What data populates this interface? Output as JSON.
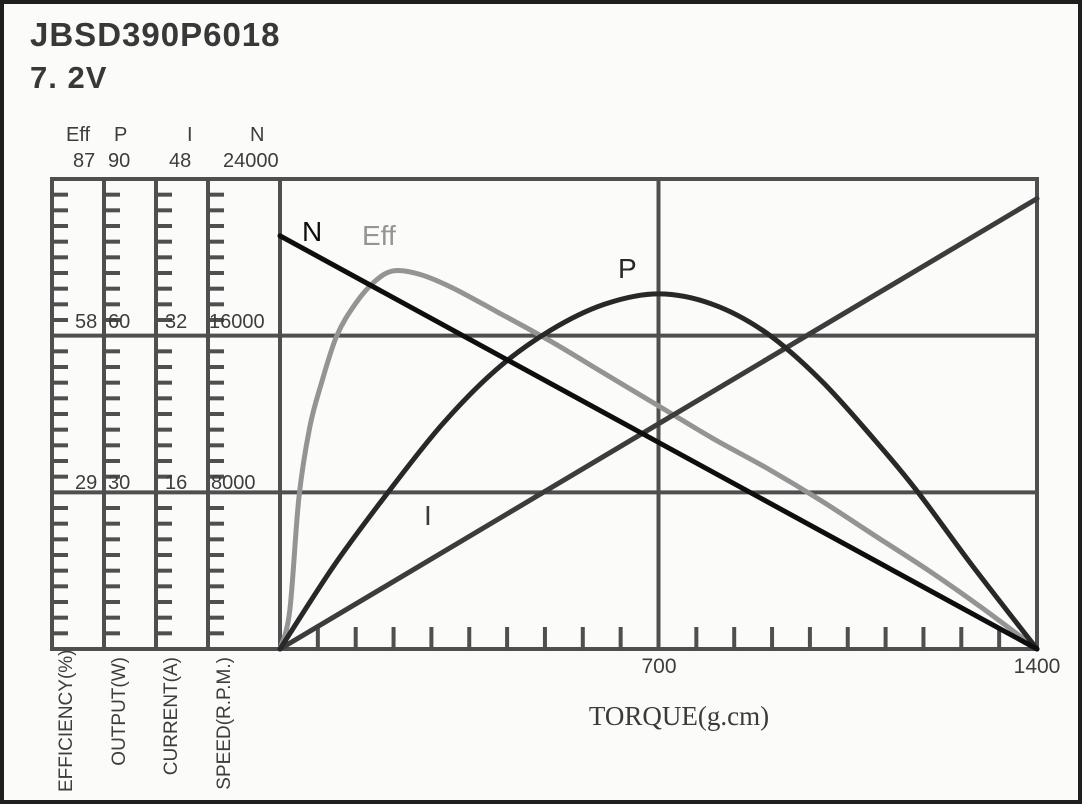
{
  "title": "JBSD390P6018",
  "voltage": "7. 2V",
  "chart_data": {
    "type": "line",
    "title": "JBSD390P6018 7.2V motor performance curves",
    "x_axis": {
      "label": "TORQUE(g.cm)",
      "min": 0,
      "max": 1400,
      "tick_labels": [
        "700",
        "1400"
      ],
      "minor_step": 70
    },
    "y_axes": [
      {
        "id": "Eff",
        "name": "Eff",
        "unit_label": "EFFICIENCY(%)",
        "min": 0,
        "max": 87,
        "scale_labels": [
          "87",
          "58",
          "29"
        ]
      },
      {
        "id": "P",
        "name": "P",
        "unit_label": "OUTPUT(W)",
        "min": 0,
        "max": 90,
        "scale_labels": [
          "90",
          "60",
          "30"
        ]
      },
      {
        "id": "I",
        "name": "I",
        "unit_label": "CURRENT(A)",
        "min": 0,
        "max": 48,
        "scale_labels": [
          "48",
          "32",
          "16"
        ]
      },
      {
        "id": "N",
        "name": "N",
        "unit_label": "SPEED(R.P.M.)",
        "min": 0,
        "max": 24000,
        "scale_labels": [
          "24000",
          "16000",
          "8000"
        ]
      }
    ],
    "series": [
      {
        "id": "Eff",
        "label": "Eff",
        "axis": "Eff",
        "color": "#949494",
        "points": [
          [
            0,
            0
          ],
          [
            18,
            7
          ],
          [
            35,
            28
          ],
          [
            55,
            41
          ],
          [
            76,
            49
          ],
          [
            105,
            58
          ],
          [
            140,
            64
          ],
          [
            175,
            68
          ],
          [
            210,
            70
          ],
          [
            260,
            69.3
          ],
          [
            320,
            66.8
          ],
          [
            400,
            62.5
          ],
          [
            500,
            57
          ],
          [
            600,
            51
          ],
          [
            700,
            45
          ],
          [
            800,
            39
          ],
          [
            900,
            33.5
          ],
          [
            1000,
            27.5
          ],
          [
            1100,
            21
          ],
          [
            1200,
            14.5
          ],
          [
            1300,
            7.5
          ],
          [
            1400,
            0
          ]
        ]
      },
      {
        "id": "I",
        "label": "I",
        "axis": "I",
        "color": "#3c3c3c",
        "points": [
          [
            0,
            0
          ],
          [
            1400,
            46
          ]
        ]
      },
      {
        "id": "P",
        "label": "P",
        "axis": "P",
        "color": "#282828",
        "points": [
          [
            0,
            0
          ],
          [
            100,
            16
          ],
          [
            200,
            30
          ],
          [
            300,
            43
          ],
          [
            400,
            53.5
          ],
          [
            500,
            61
          ],
          [
            600,
            66
          ],
          [
            700,
            68
          ],
          [
            800,
            66
          ],
          [
            900,
            60.5
          ],
          [
            1000,
            51.5
          ],
          [
            1100,
            40
          ],
          [
            1180,
            30
          ],
          [
            1280,
            16
          ],
          [
            1400,
            0
          ]
        ]
      },
      {
        "id": "N",
        "label": "N",
        "axis": "N",
        "color": "#0e0e0e",
        "points": [
          [
            0,
            21100
          ],
          [
            1400,
            0
          ]
        ]
      }
    ],
    "grid": true,
    "legend_position": "inline-curve-labels",
    "colors": {
      "grid": "#4f4f4f",
      "text": "#3d3d3d",
      "background": "#fbfbf9",
      "border": "#1f1f1f"
    }
  }
}
